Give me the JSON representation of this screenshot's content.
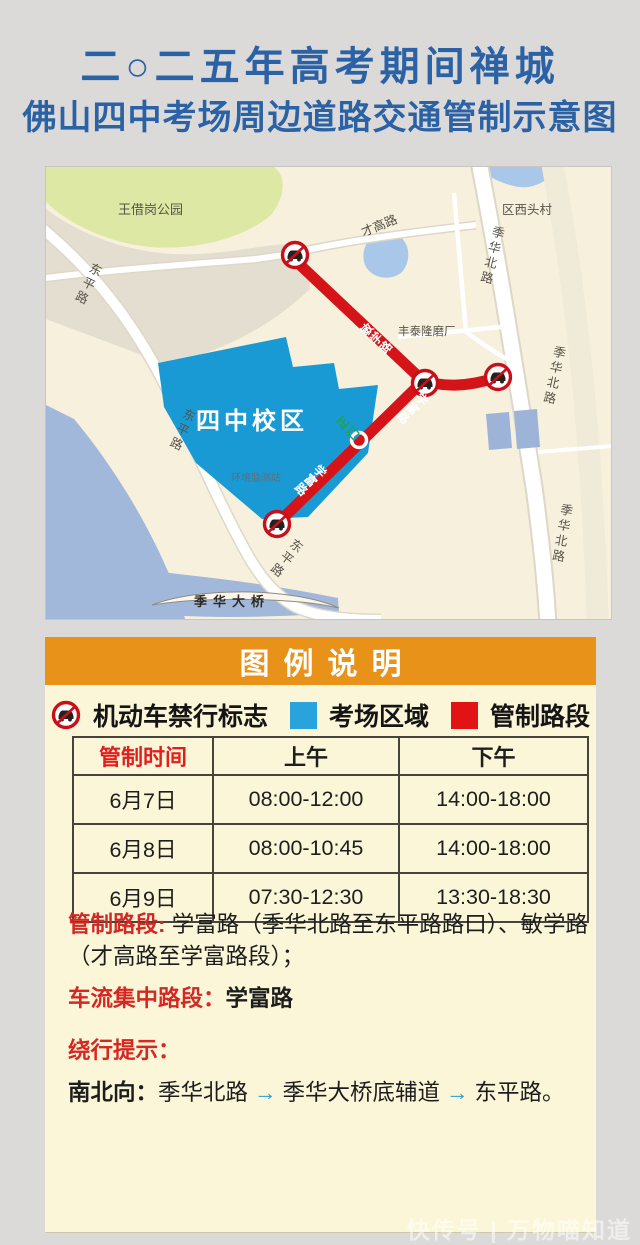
{
  "title": {
    "line1": "二○二五年高考期间禅城",
    "line2": "佛山四中考场周边道路交通管制示意图"
  },
  "map": {
    "labels": {
      "park": "王借岗公园",
      "village": "区西头村",
      "caigao_road": "才高路",
      "jihua_north_road": "季华北路",
      "factory": "丰泰隆磨厂",
      "dongping_road": "东平路",
      "school": "四中校区",
      "station": "环境监测站",
      "gate": "正门",
      "bridge": "季华大桥",
      "minxue_road": "敏学路",
      "xuefu_road": "学富路"
    },
    "colors": {
      "school_area": "#1a9ad5",
      "restricted_road": "#d41418",
      "water": "#a9c7e8",
      "park": "#dde8a5"
    }
  },
  "legend": {
    "header": "图例说明",
    "items": [
      {
        "label": "机动车禁行标志"
      },
      {
        "label": "考场区域"
      },
      {
        "label": "管制路段"
      }
    ],
    "exam_area_color": "#29a3dc",
    "restricted_color": "#e11315"
  },
  "table": {
    "headers": [
      "管制时间",
      "上午",
      "下午"
    ],
    "rows": [
      [
        "6月7日",
        "08:00-12:00",
        "14:00-18:00"
      ],
      [
        "6月8日",
        "08:00-10:45",
        "14:00-18:00"
      ],
      [
        "6月9日",
        "07:30-12:30",
        "13:30-18:30"
      ]
    ]
  },
  "notes": {
    "restricted_label": "管制路段:",
    "restricted_text": " 学富路（季华北路至东平路路口）、敏学路（才高路至学富路段）；",
    "flow_label": "车流集中路段：",
    "flow_text": "学富路",
    "detour_label": "绕行提示：",
    "direction_label": "南北向：",
    "route_1": "季华北路",
    "route_2": "季华大桥底辅道",
    "route_3": "东平路。",
    "arrow": "→"
  },
  "watermark": "快传号 | 万物喵知道"
}
